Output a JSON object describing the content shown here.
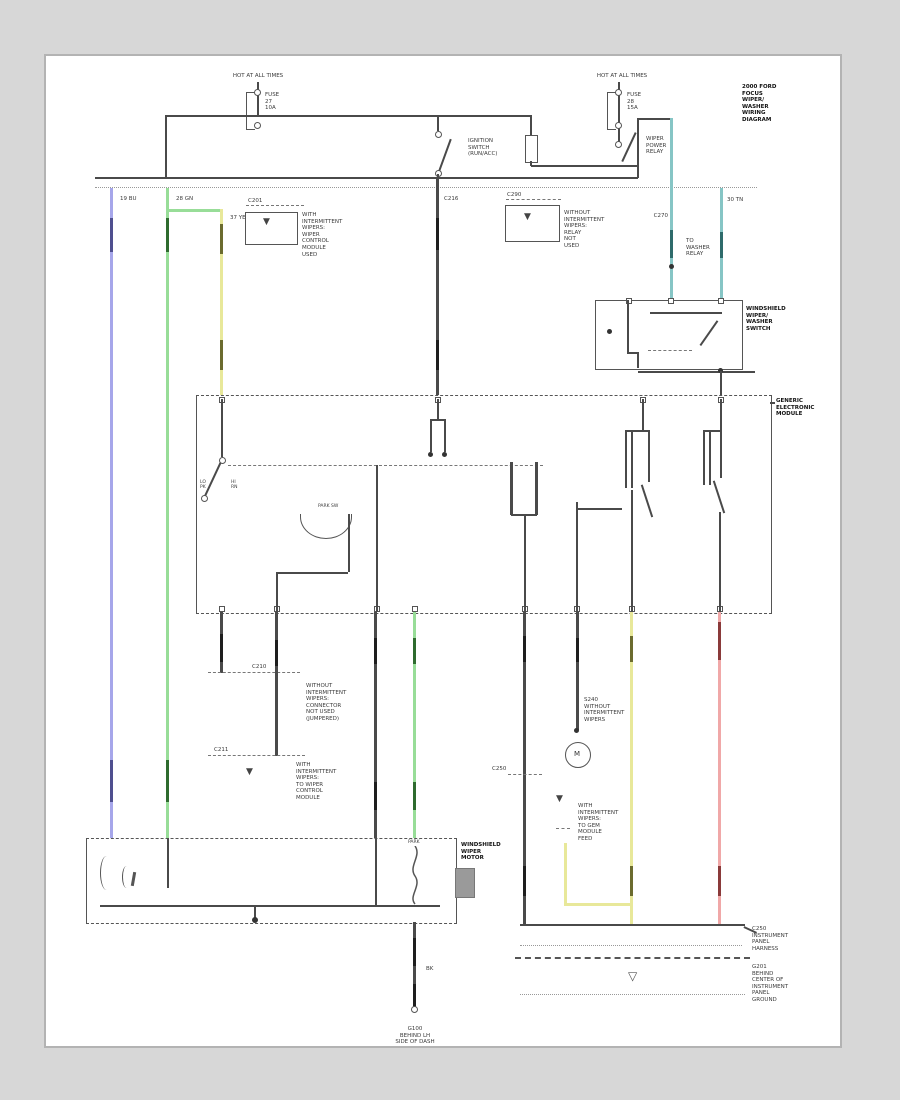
{
  "diagram": {
    "title_block": "2000 FORD\nFOCUS\nWIPER/\nWASHER\nWIRING\nDIAGRAM",
    "feed_left": {
      "hot": "HOT AT ALL TIMES",
      "fuse": "FUSE\n27\n10A"
    },
    "feed_right": {
      "hot": "HOT AT ALL TIMES",
      "fuse": "FUSE\n28\n15A"
    },
    "ignition_switch": "IGNITION\nSWITCH\n(RUN/ACC)",
    "wiper_relay": "WIPER\nPOWER\nRELAY",
    "note_box1": {
      "connector": "C201",
      "text": "WITH\nINTERMITTENT\nWIPERS:\nWIPER\nCONTROL\nMODULE\nUSED"
    },
    "note_box2": {
      "connector": "C290",
      "text": "WITHOUT\nINTERMITTENT\nWIPERS:\nRELAY\nNOT\nUSED"
    },
    "wire_codes": {
      "blue": "19 BU",
      "green": "28 GN",
      "yellow": "37 YE",
      "black": "C216",
      "teal1": "C270",
      "teal2": "30 TN",
      "teal1_note": "TO\nWASHER\nRELAY",
      "ground_wire": "BK"
    },
    "washer_switch": "WINDSHIELD\nWIPER/\nWASHER\nSWITCH",
    "gem": {
      "label": "GENERIC\nELECTRONIC\nMODULE",
      "park": "PARK SW",
      "pins_left": "LO\nPK",
      "pins_right": "HI\nRN"
    },
    "conn1": "C210",
    "conn2": "C211",
    "conn3": "C250",
    "note_no_int": "WITHOUT\nINTERMITTENT\nWIPERS:\nCONNECTOR\nNOT USED\n(JUMPERED)",
    "note_with_int": "WITH\nINTERMITTENT\nWIPERS:\nTO WIPER\nCONTROL\nMODULE",
    "note_s240": "S240\nWITHOUT\nINTERMITTENT\nWIPERS",
    "note_gem_feed": "WITH\nINTERMITTENT\nWIPERS:\nTO GEM\nMODULE\nFEED",
    "pump_m": "M",
    "wiper_motor": {
      "label": "WINDSHIELD\nWIPER\nMOTOR",
      "park": "PARK"
    },
    "g100": "G100\nBEHIND LH\nSIDE OF DASH",
    "strip_c250": "C250\nINSTRUMENT\nPANEL\nHARNESS",
    "g201": "G201\nBEHIND\nCENTER OF\nINSTRUMENT\nPANEL\nGROUND",
    "ground_triangle": "▽",
    "splice_triangle": "▼",
    "colors": {
      "blue": "#a6a6ea",
      "green": "#98dd98",
      "yellow": "#e8e89a",
      "teal": "#86c5c5",
      "red": "#f0a8a8",
      "line": "#4a4a4a"
    }
  }
}
